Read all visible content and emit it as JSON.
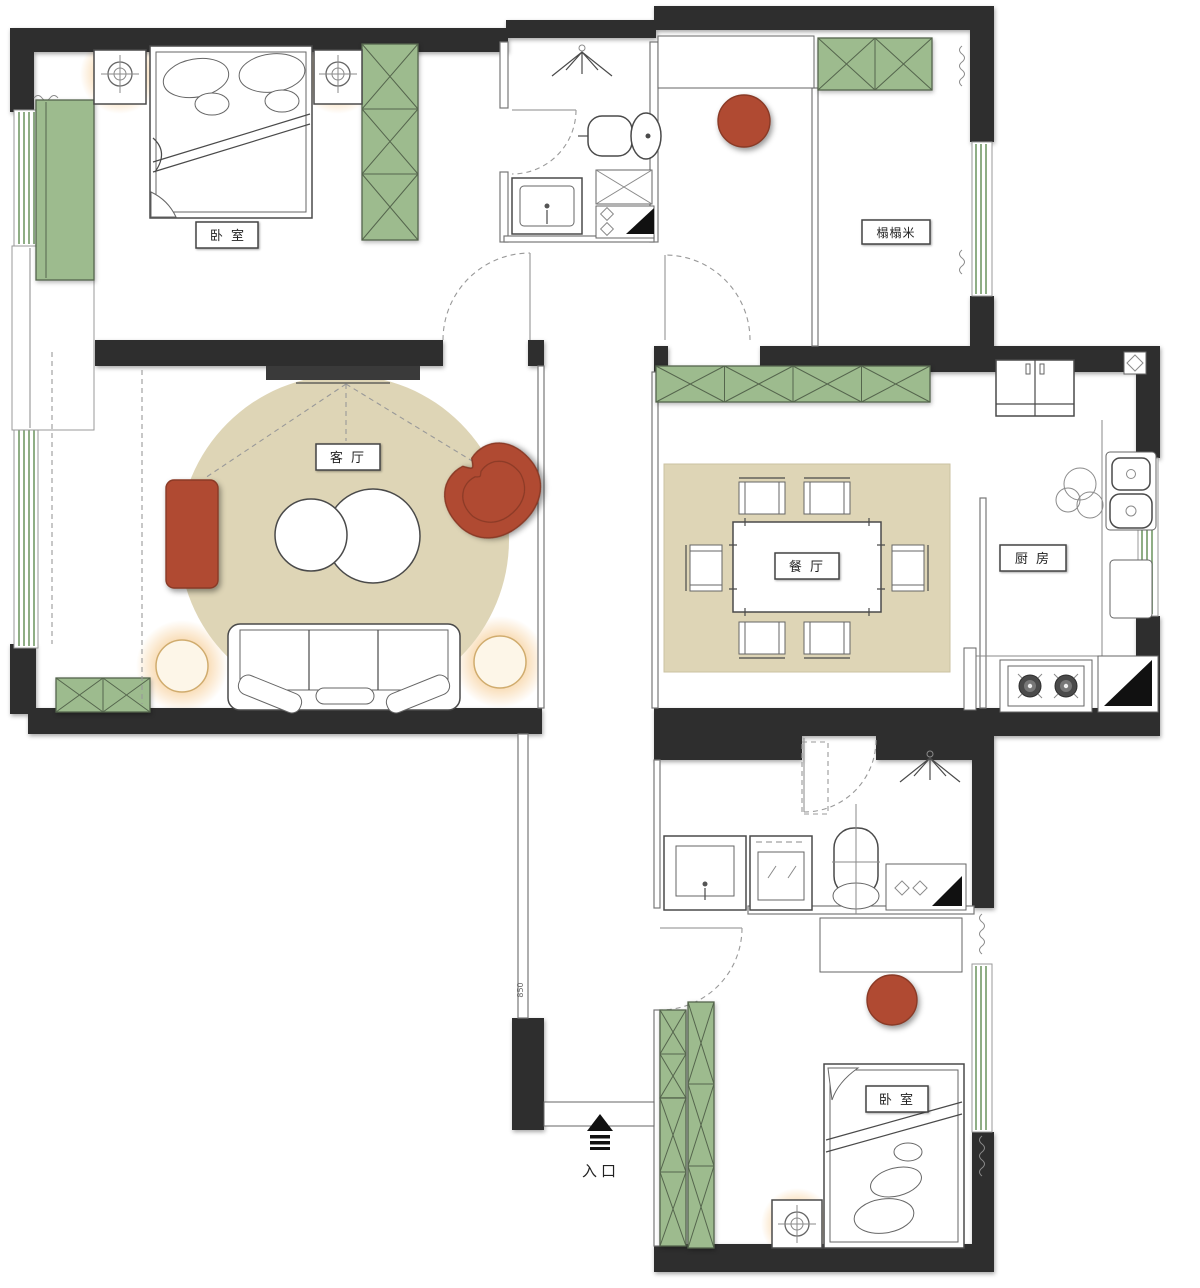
{
  "colors": {
    "wall": "#2e2e2e",
    "cabinet_green": "#9dbb8e",
    "cabinet_green_border": "#55654d",
    "window_green": "#8fae85",
    "rug_beige": "#ded5b6",
    "accent_red": "#b04a32",
    "accent_red_border": "#8a3a26",
    "lamp_glow": "#f2b35e",
    "line": "#555555"
  },
  "rooms": {
    "bedroom_master": {
      "label": "卧 室"
    },
    "tatami": {
      "label": "榻榻米"
    },
    "living": {
      "label": "客 厅"
    },
    "dining": {
      "label": "餐 厅"
    },
    "kitchen": {
      "label": "厨 房"
    },
    "bedroom_second": {
      "label": "卧 室"
    }
  },
  "entrance": {
    "label": "入口"
  },
  "corridor": {
    "dimension": "850"
  },
  "icons": {
    "entrance_arrow": "up-arrow",
    "shower": "shower-sprinkler",
    "lamp": "crosshair-lamp",
    "stove": "two-burner-stove",
    "floor_drain": "corner-triangle"
  }
}
